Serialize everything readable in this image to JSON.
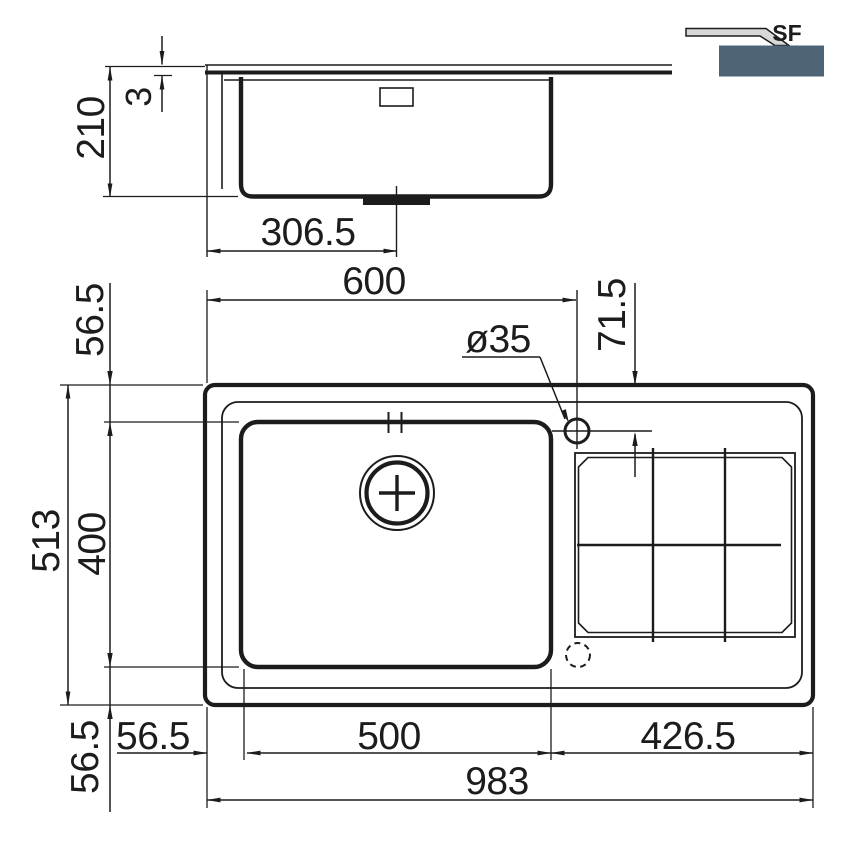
{
  "drawing": {
    "colors": {
      "line": "#1c1c1c",
      "logo_panel": "#4e6577",
      "logo_profile": "#d8d8d8",
      "background": "#ffffff"
    },
    "logo": {
      "type_label": "SF"
    },
    "side_view": {
      "overall_height": "210",
      "rim_thickness": "3",
      "drain_offset": "306.5"
    },
    "plan_view": {
      "rim_to_bowl_top": "56.5",
      "edge_to_tap_center": "600",
      "rim_to_tap_center": "71.5",
      "tap_hole_diameter": "ø35",
      "overall_depth": "513",
      "bowl_depth": "400",
      "edge_to_bowl_left": "56.5",
      "bowl_width": "500",
      "drainer_width": "426.5",
      "overall_width": "983",
      "bowl_to_bottom_edge": "56.5"
    }
  }
}
